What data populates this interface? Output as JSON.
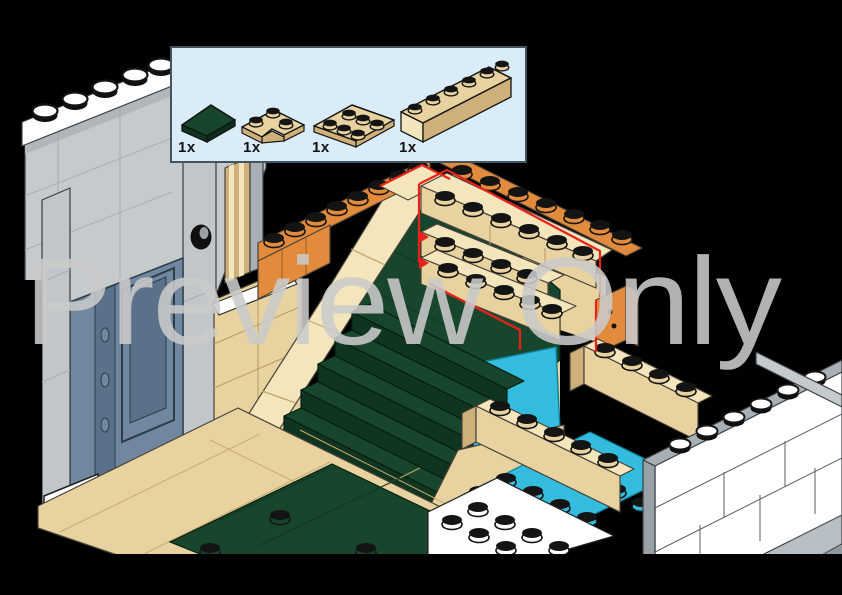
{
  "watermark": {
    "text": "Preview Only"
  },
  "parts_panel": {
    "items": [
      {
        "name": "wedge-plate-dark-green",
        "count": "1x"
      },
      {
        "name": "corner-plate-2x2-tan",
        "count": "1x"
      },
      {
        "name": "plate-2x3-tan",
        "count": "1x"
      },
      {
        "name": "brick-1x6-tan",
        "count": "1x"
      }
    ]
  },
  "colors": {
    "bg": "#000000",
    "panel_bg": "#d9ecf8",
    "panel_border": "#43545e",
    "tan": "#e8d3a0",
    "tan_light": "#f3e5bc",
    "tan_dark": "#cfb07a",
    "dark_green": "#17462c",
    "dark_green_deep": "#0f3520",
    "orange": "#e28b3c",
    "orange_dark": "#c97730",
    "azure": "#33bcdd",
    "sand_blue": "#70879f",
    "sand_blue_dark": "#5a7189",
    "wall_gray": "#c5cacd",
    "wall_gray_dark": "#b0b6ba",
    "trim_gray": "#a8afb5",
    "white": "#ffffff",
    "red": "#e8221a",
    "watermark": "#cbcbcb"
  }
}
